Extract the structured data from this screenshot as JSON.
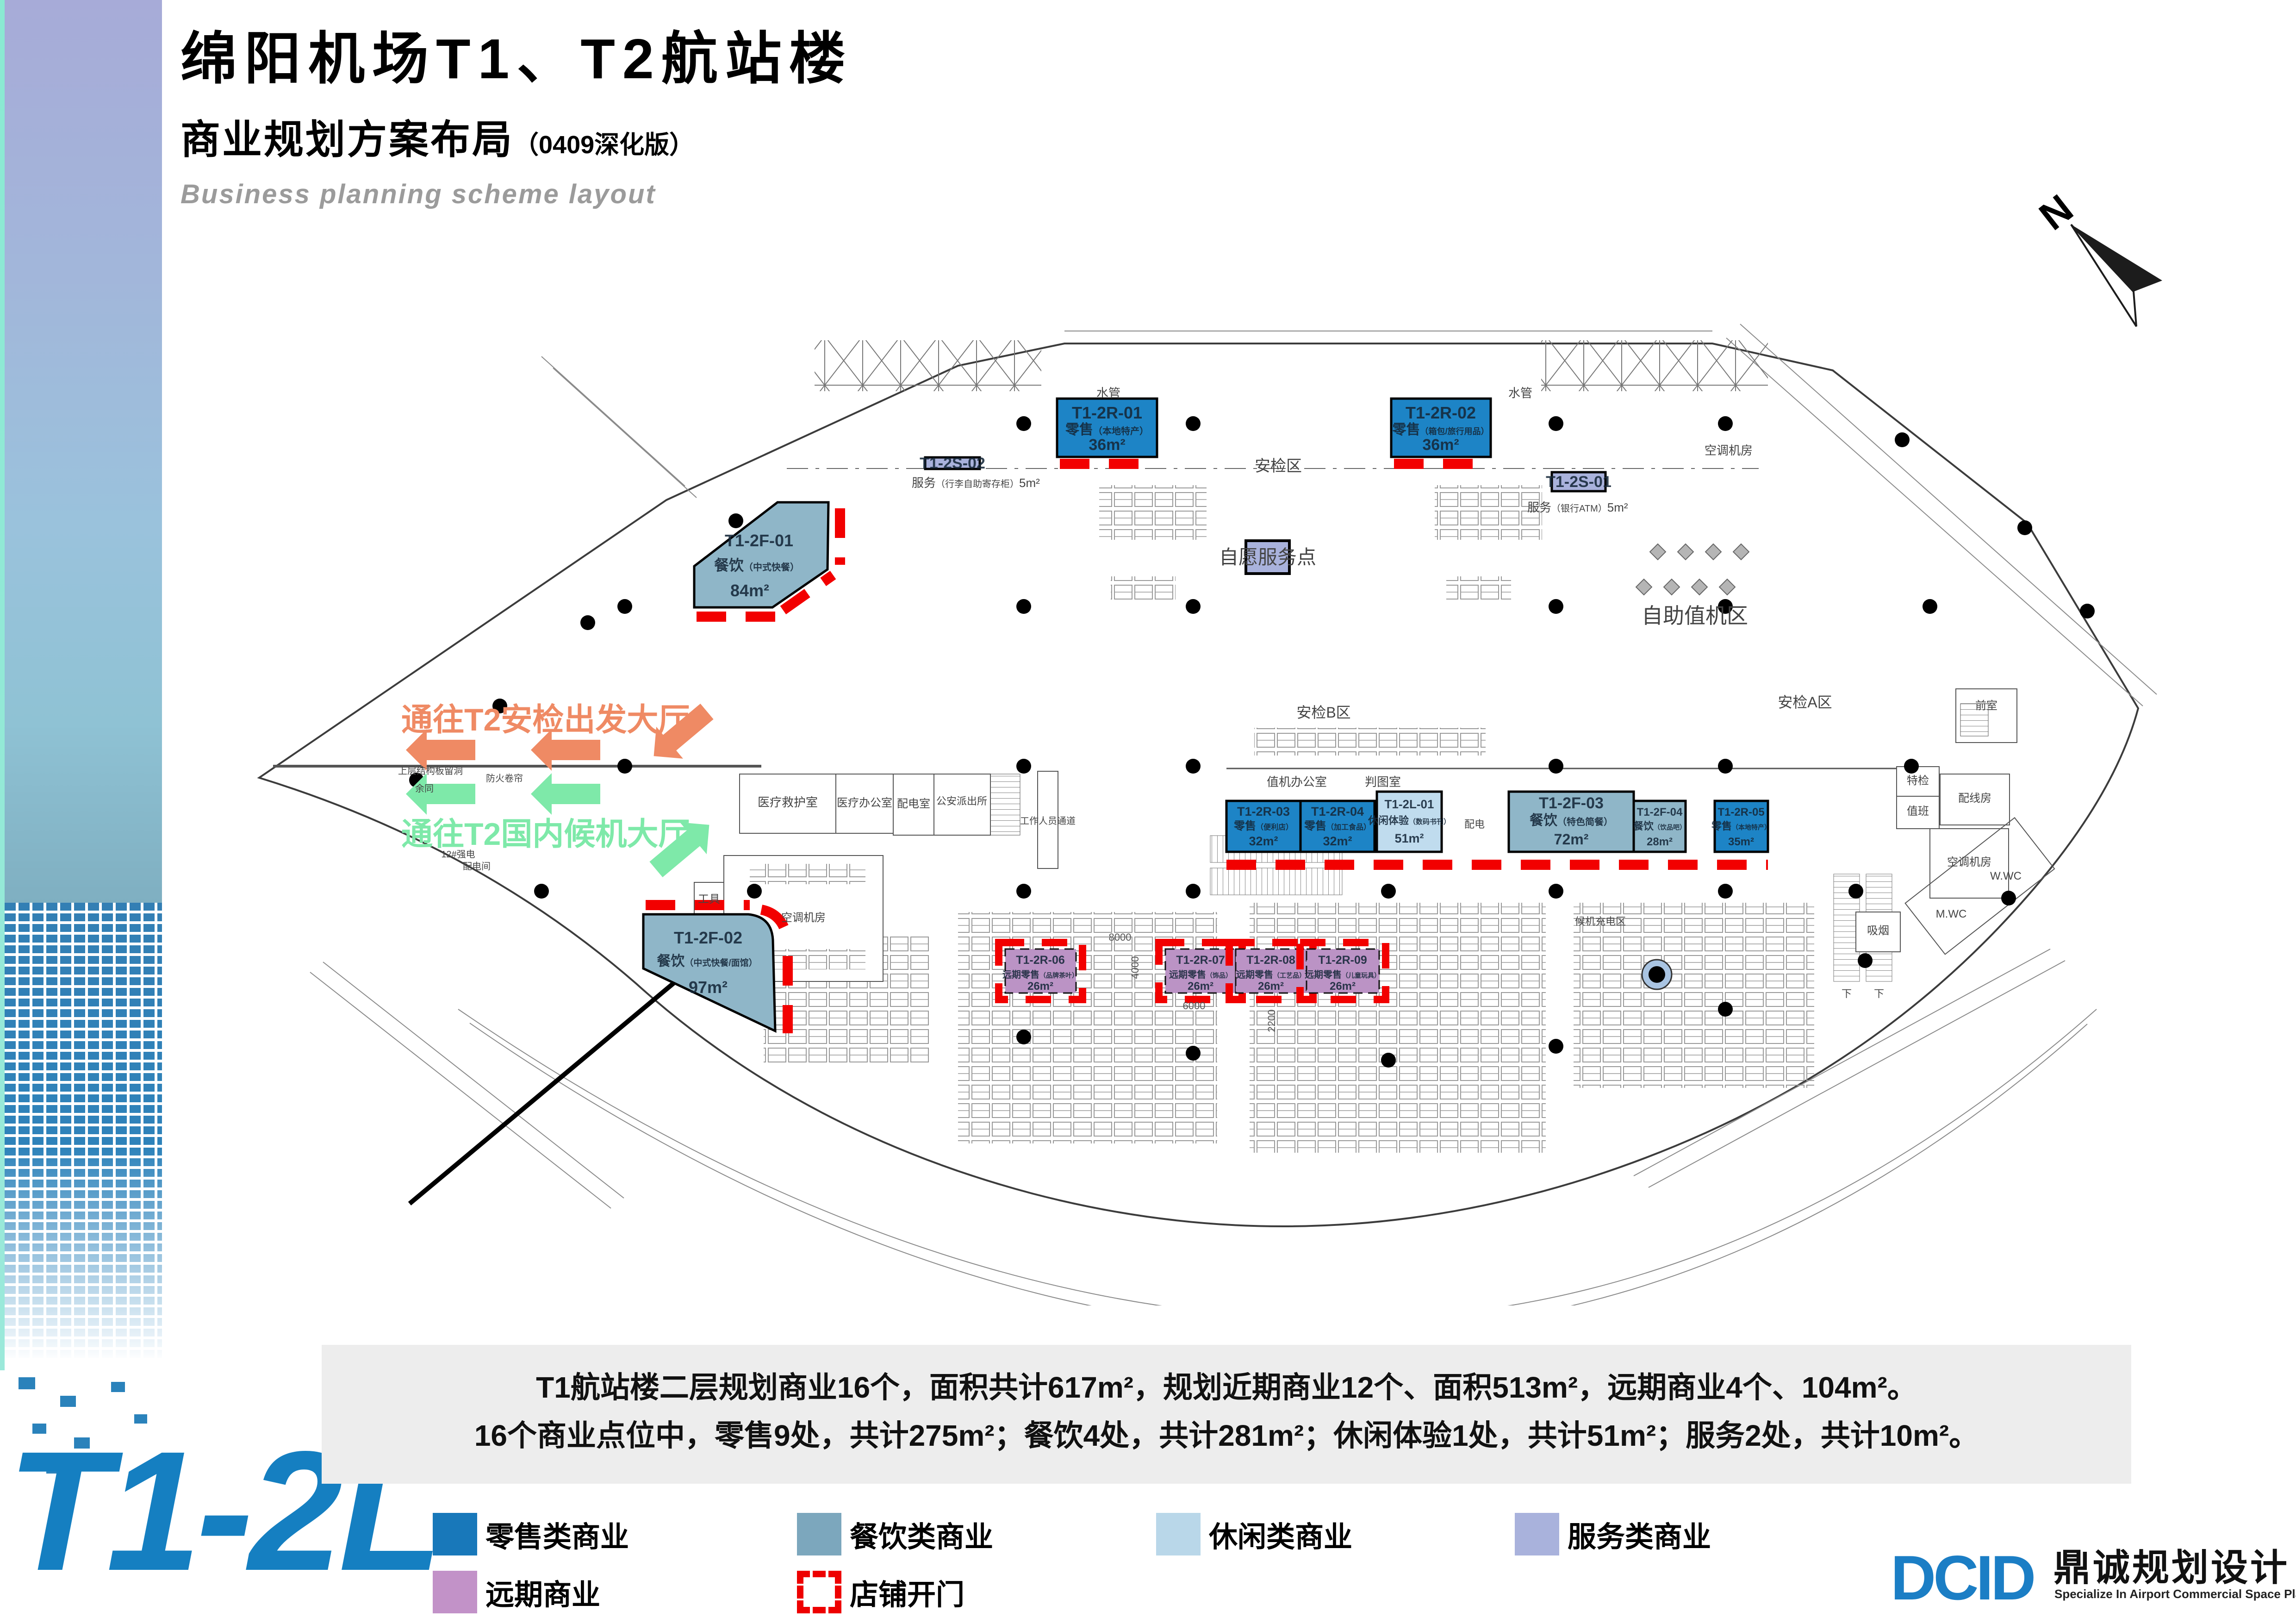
{
  "header": {
    "title": "绵阳机场T1、T2航站楼",
    "subtitle": "商业规划方案布局",
    "subtitle_note": "（0409深化版）",
    "english": "Business planning scheme layout"
  },
  "floor_code": "T1-2L",
  "north_label": "N",
  "plan": {
    "units": [
      {
        "code": "T1-2R-01",
        "name": "零售",
        "detail": "（本地特产）",
        "area": "36m²",
        "category": "retail"
      },
      {
        "code": "T1-2R-02",
        "name": "零售",
        "detail": "（箱包/旅行用品）",
        "area": "36m²",
        "category": "retail"
      },
      {
        "code": "T1-2F-01",
        "name": "餐饮",
        "detail": "（中式快餐）",
        "area": "84m²",
        "category": "food"
      },
      {
        "code": "T1-2S-02",
        "name": "服务",
        "detail": "（行李自助寄存柜）",
        "area": "5m²",
        "category": "service"
      },
      {
        "code": "T1-2S-01",
        "name": "服务",
        "detail": "（银行ATM）",
        "area": "5m²",
        "category": "service"
      },
      {
        "code": "T1-2R-03",
        "name": "零售",
        "detail": "（便利店）",
        "area": "32m²",
        "category": "retail"
      },
      {
        "code": "T1-2R-04",
        "name": "零售",
        "detail": "（加工食品）",
        "area": "32m²",
        "category": "retail"
      },
      {
        "code": "T1-2L-01",
        "name": "休闲体验",
        "detail": "（数码书刊）",
        "area": "51m²",
        "category": "leisure"
      },
      {
        "code": "T1-2F-03",
        "name": "餐饮",
        "detail": "（特色简餐）",
        "area": "72m²",
        "category": "food"
      },
      {
        "code": "T1-2F-04",
        "name": "餐饮",
        "detail": "（饮品吧）",
        "area": "28m²",
        "category": "food"
      },
      {
        "code": "T1-2R-05",
        "name": "零售",
        "detail": "（本地特产）",
        "area": "35m²",
        "category": "retail"
      },
      {
        "code": "T1-2F-02",
        "name": "餐饮",
        "detail": "（中式快餐/面馆）",
        "area": "97m²",
        "category": "food"
      },
      {
        "code": "T1-2R-06",
        "name": "远期零售",
        "detail": "（品牌茶叶）",
        "area": "26m²",
        "category": "future"
      },
      {
        "code": "T1-2R-07",
        "name": "远期零售",
        "detail": "（饰品）",
        "area": "26m²",
        "category": "future"
      },
      {
        "code": "T1-2R-08",
        "name": "远期零售",
        "detail": "（工艺品）",
        "area": "26m²",
        "category": "future"
      },
      {
        "code": "T1-2R-09",
        "name": "远期零售",
        "detail": "（儿童玩具）",
        "area": "26m²",
        "category": "future"
      }
    ],
    "volunteer_point": "自愿服务点",
    "route_notes": [
      {
        "text": "通往T2安检出发大厅",
        "color": "#ef8a64"
      },
      {
        "text": "通往T2国内候机大厅",
        "color": "#7ee9a9"
      }
    ],
    "labels": [
      {
        "text": "安检区"
      },
      {
        "text": "水管"
      },
      {
        "text": "水管"
      },
      {
        "text": "自助值机区"
      },
      {
        "text": "空调机房"
      },
      {
        "text": "安检B区"
      },
      {
        "text": "安检A区"
      },
      {
        "text": "值机办公室"
      },
      {
        "text": "判图室"
      },
      {
        "text": "配电"
      },
      {
        "text": "配电室"
      },
      {
        "text": "公安派出所"
      },
      {
        "text": "工作人员通道"
      },
      {
        "text": "医疗救护室"
      },
      {
        "text": "医疗办公室"
      },
      {
        "text": "工具"
      },
      {
        "text": "空调机房"
      },
      {
        "text": "特检"
      },
      {
        "text": "值班"
      },
      {
        "text": "前室"
      },
      {
        "text": "配线房"
      },
      {
        "text": "空调机房"
      },
      {
        "text": "吸烟"
      },
      {
        "text": "M.WC"
      },
      {
        "text": "W.WC"
      },
      {
        "text": "候机充电区"
      },
      {
        "text": "上层结构板留洞"
      },
      {
        "text": "防火卷帘"
      },
      {
        "text": "余同"
      },
      {
        "text": "12#强电"
      },
      {
        "text": "配电间"
      },
      {
        "text": "下"
      },
      {
        "text": "下"
      }
    ],
    "dims": [
      "8000",
      "4000",
      "6000",
      "2200"
    ]
  },
  "summary": {
    "line1": "T1航站楼二层规划商业16个，面积共计617m²，规划近期商业12个、面积513m²，远期商业4个、104m²。",
    "line2": "16个商业点位中，零售9处，共计275m²；餐饮4处，共计281m²；休闲体验1处，共计51m²；服务2处，共计10m²。"
  },
  "legend": {
    "items": [
      {
        "label": "零售类商业",
        "color": "#1878ba"
      },
      {
        "label": "餐饮类商业",
        "color": "#7ca7bd"
      },
      {
        "label": "休闲类商业",
        "color": "#b9d7e9"
      },
      {
        "label": "服务类商业",
        "color": "#a9b2dc"
      },
      {
        "label": "远期商业",
        "color": "#c292c8"
      }
    ],
    "door": {
      "label": "店铺开门",
      "color": "#ee0000"
    }
  },
  "logo": {
    "initials": "DCID",
    "name": "鼎诚规划设计",
    "tagline": "Specialize In Airport Commercial Space Planning And Designing"
  }
}
